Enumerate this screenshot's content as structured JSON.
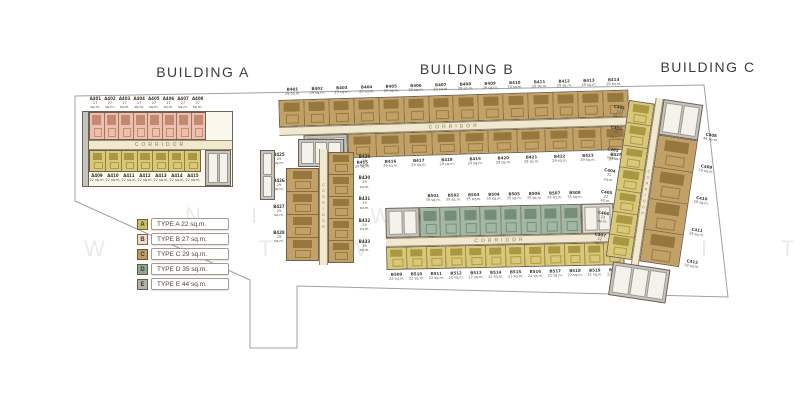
{
  "titles": {
    "building_a": "BUILDING A",
    "building_b": "BUILDING B",
    "building_c": "BUILDING C"
  },
  "corridor_label": "CORRIDOR",
  "legend": {
    "items": [
      {
        "letter": "A",
        "label": "TYPE A 22 sq.m.",
        "color": "#cdbd62"
      },
      {
        "letter": "B",
        "label": "TYPE B 27 sq.m.",
        "color": "#f0d9cd"
      },
      {
        "letter": "C",
        "label": "TYPE C 29 sq.m.",
        "color": "#c09a62"
      },
      {
        "letter": "D",
        "label": "TYPE D 35 sq.m.",
        "color": "#8fa893"
      },
      {
        "letter": "E",
        "label": "TYPE E 44 sq.m.",
        "color": "#b3b3af"
      }
    ]
  },
  "watermark": {
    "row1": "N I T W",
    "row2": "W I T W I C H I T"
  },
  "buildings": {
    "a": {
      "top_units": [
        {
          "no": "A401",
          "area": "27 sq.m."
        },
        {
          "no": "A402",
          "area": "27 sq.m."
        },
        {
          "no": "A403",
          "area": "27 sq.m."
        },
        {
          "no": "A404",
          "area": "27 sq.m."
        },
        {
          "no": "A405",
          "area": "27 sq.m."
        },
        {
          "no": "A406",
          "area": "27 sq.m."
        },
        {
          "no": "A407",
          "area": "27 sq.m."
        },
        {
          "no": "A408",
          "area": "27 sq.m."
        }
      ],
      "bottom_units": [
        {
          "no": "A409",
          "area": "22 sq.m."
        },
        {
          "no": "A410",
          "area": "22 sq.m."
        },
        {
          "no": "A411",
          "area": "22 sq.m."
        },
        {
          "no": "A412",
          "area": "22 sq.m."
        },
        {
          "no": "A413",
          "area": "22 sq.m."
        },
        {
          "no": "A414",
          "area": "22 sq.m."
        },
        {
          "no": "A415",
          "area": "22 sq.m."
        }
      ]
    },
    "b": {
      "top_units": [
        {
          "no": "B401",
          "area": "29 sq.m."
        },
        {
          "no": "B402",
          "area": "29 sq.m."
        },
        {
          "no": "B403",
          "area": "29 sq.m."
        },
        {
          "no": "B404",
          "area": "29 sq.m."
        },
        {
          "no": "B405",
          "area": "29 sq.m."
        },
        {
          "no": "B406",
          "area": "29 sq.m."
        },
        {
          "no": "B407",
          "area": "29 sq.m."
        },
        {
          "no": "B408",
          "area": "29 sq.m."
        },
        {
          "no": "B409",
          "area": "29 sq.m."
        },
        {
          "no": "B410",
          "area": "29 sq.m."
        },
        {
          "no": "B411",
          "area": "29 sq.m."
        },
        {
          "no": "B412",
          "area": "29 sq.m."
        },
        {
          "no": "B413",
          "area": "29 sq.m."
        },
        {
          "no": "B414",
          "area": "29 sq.m."
        }
      ],
      "bottom_units": [
        {
          "no": "B415",
          "area": "29 sq.m."
        },
        {
          "no": "B416",
          "area": "29 sq.m."
        },
        {
          "no": "B417",
          "area": "29 sq.m."
        },
        {
          "no": "B418",
          "area": "29 sq.m."
        },
        {
          "no": "B419",
          "area": "29 sq.m."
        },
        {
          "no": "B420",
          "area": "29 sq.m."
        },
        {
          "no": "B421",
          "area": "29 sq.m."
        },
        {
          "no": "B422",
          "area": "29 sq.m."
        },
        {
          "no": "B423",
          "area": "29 sq.m."
        },
        {
          "no": "B424",
          "area": "29 sq.m."
        }
      ],
      "wing_left": [
        {
          "no": "B425",
          "area": "29 sq.m."
        },
        {
          "no": "B426",
          "area": "29 sq.m."
        },
        {
          "no": "B427",
          "area": "29 sq.m."
        },
        {
          "no": "B428",
          "area": "29 sq.m."
        }
      ],
      "wing_right": [
        {
          "no": "B429",
          "area": "29 sq.m."
        },
        {
          "no": "B430",
          "area": "29 sq.m."
        },
        {
          "no": "B431",
          "area": "29 sq.m."
        },
        {
          "no": "B432",
          "area": "29 sq.m."
        },
        {
          "no": "B433",
          "area": "29 sq.m."
        }
      ]
    },
    "south": {
      "green_units": [
        {
          "no": "B501",
          "area": "35 sq.m."
        },
        {
          "no": "B502",
          "area": "35 sq.m."
        },
        {
          "no": "B503",
          "area": "35 sq.m."
        },
        {
          "no": "B504",
          "area": "35 sq.m."
        },
        {
          "no": "B505",
          "area": "35 sq.m."
        },
        {
          "no": "B506",
          "area": "35 sq.m."
        },
        {
          "no": "B507",
          "area": "35 sq.m."
        },
        {
          "no": "B508",
          "area": "35 sq.m."
        }
      ],
      "yellow_units": [
        {
          "no": "B509",
          "area": "22 sq.m."
        },
        {
          "no": "B510",
          "area": "22 sq.m."
        },
        {
          "no": "B511",
          "area": "22 sq.m."
        },
        {
          "no": "B512",
          "area": "22 sq.m."
        },
        {
          "no": "B513",
          "area": "22 sq.m."
        },
        {
          "no": "B514",
          "area": "22 sq.m."
        },
        {
          "no": "B515",
          "area": "22 sq.m."
        },
        {
          "no": "B516",
          "area": "22 sq.m."
        },
        {
          "no": "B517",
          "area": "22 sq.m."
        },
        {
          "no": "B518",
          "area": "22 sq.m."
        },
        {
          "no": "B519",
          "area": "22 sq.m."
        },
        {
          "no": "B520",
          "area": "22 sq.m."
        }
      ]
    },
    "c": {
      "left_units": [
        {
          "no": "C401",
          "area": "22 sq.m."
        },
        {
          "no": "C402",
          "area": "22 sq.m."
        },
        {
          "no": "C403",
          "area": "22 sq.m."
        },
        {
          "no": "C404",
          "area": "22 sq.m."
        },
        {
          "no": "C405",
          "area": "22 sq.m."
        },
        {
          "no": "C406",
          "area": "22 sq.m."
        },
        {
          "no": "C407",
          "area": "22 sq.m."
        }
      ],
      "right_units": [
        {
          "no": "C409",
          "area": "29 sq.m."
        },
        {
          "no": "C410",
          "area": "29 sq.m."
        },
        {
          "no": "C411",
          "area": "29 sq.m."
        },
        {
          "no": "C412",
          "area": "29 sq.m."
        }
      ],
      "right_labels": [
        {
          "no": "C408",
          "area": "44 sq.m."
        },
        {
          "no": "C409",
          "area": "29 sq.m."
        },
        {
          "no": "C410",
          "area": "29 sq.m."
        },
        {
          "no": "C411",
          "area": "29 sq.m."
        },
        {
          "no": "C412",
          "area": "29 sq.m."
        }
      ]
    }
  }
}
